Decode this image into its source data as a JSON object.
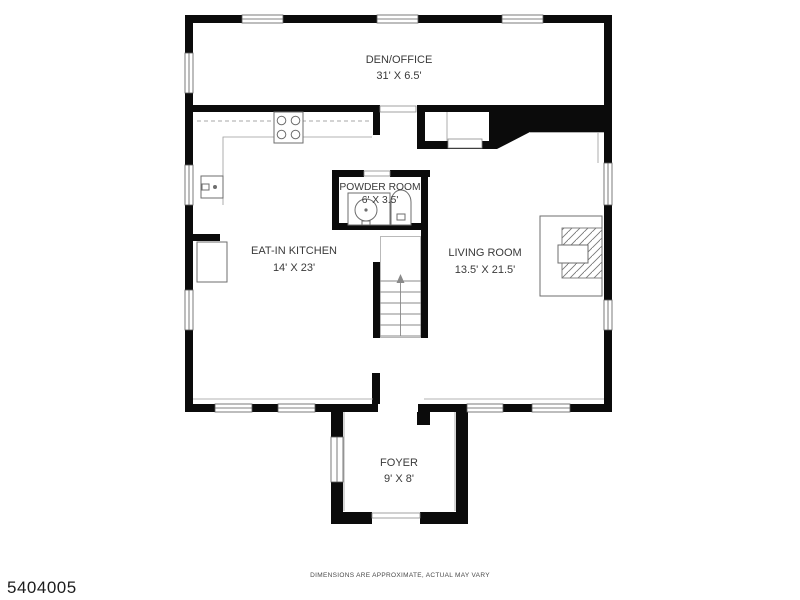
{
  "plan": {
    "type": "floor-plan",
    "rooms": [
      {
        "name": "DEN/OFFICE",
        "dimensions": "31' X 6.5'"
      },
      {
        "name": "POWDER ROOM",
        "dimensions": "6' X 3.5'"
      },
      {
        "name": "EAT-IN KITCHEN",
        "dimensions": "14' X 23'"
      },
      {
        "name": "LIVING ROOM",
        "dimensions": "13.5' X 21.5'"
      },
      {
        "name": "FOYER",
        "dimensions": "9' X 8'"
      }
    ],
    "fixtures": [
      "stove-icon",
      "kitchen-sink-icon",
      "refrigerator-icon",
      "powder-sink-icon",
      "toilet-icon",
      "fireplace-icon",
      "staircase-icon"
    ],
    "colors": {
      "wall": "#0b0b0b",
      "fixture_line": "#6e6e6e",
      "text": "#3a3a3a",
      "background": "#ffffff"
    }
  },
  "footer": {
    "listing_id": "5404005",
    "disclaimer": "DIMENSIONS ARE APPROXIMATE, ACTUAL MAY VARY"
  }
}
